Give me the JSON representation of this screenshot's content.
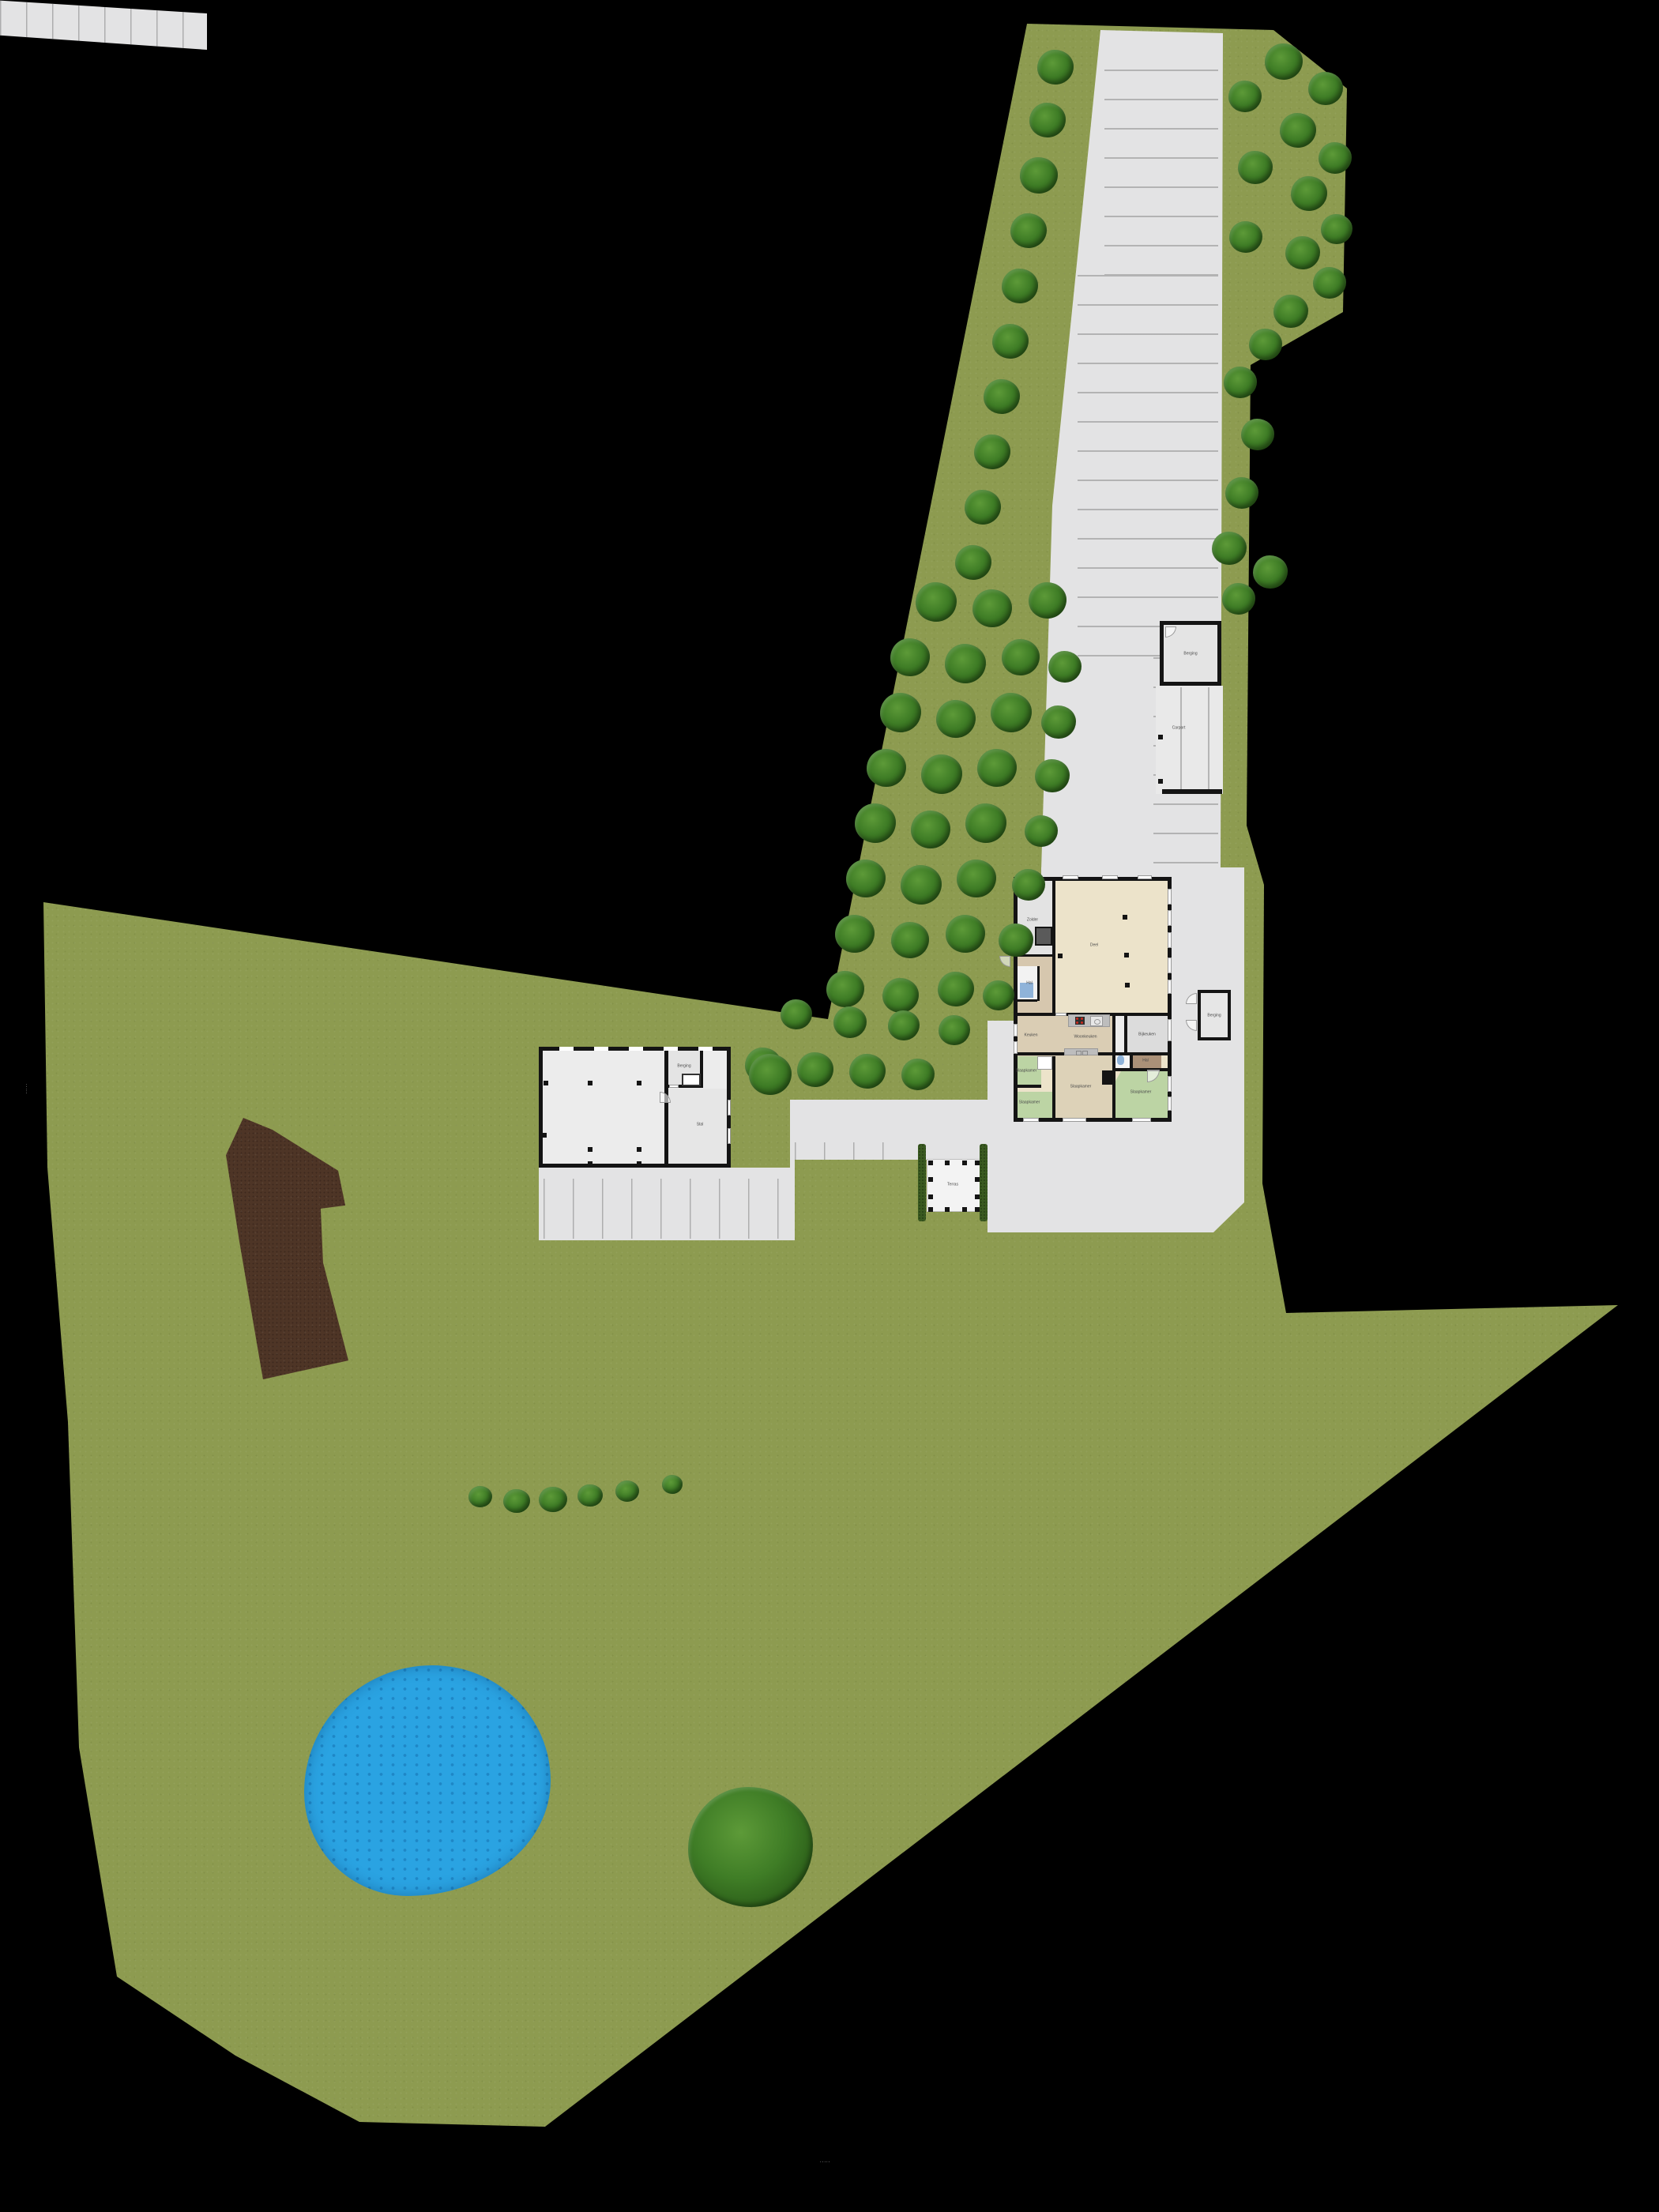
{
  "colors": {
    "background": "#000000",
    "grass": "#8d9b50",
    "pavement": "#e3e3e4",
    "wall": "#141414",
    "water": "#2aa3e2",
    "water_deep": "#1e87c6",
    "dirt": "#4e3526",
    "tree_dark": "#2a5c18",
    "tree_mid": "#3f7d26",
    "tree_light": "#5d9a38",
    "hedge": "#3a5a20",
    "room_beige": "#ece3ca",
    "room_tan": "#d6c7ae",
    "room_kitchen": "#dacdb4",
    "room_green": "#bcd4a4",
    "room_gray": "#dcdcdc",
    "room_brown": "#ab9178",
    "toilet_blue": "#8fb3d9",
    "counter": "#bdbdbd",
    "stove_red": "#cc2a1e"
  },
  "labels": {
    "watermark_left": "·····",
    "watermark_bottom": "·····",
    "garage": "Berging",
    "carport": "Carport",
    "outbuilding": "Berging",
    "pergola": "Terras",
    "barn_small": "Berging",
    "barn_large": "Stal",
    "house_attic": "Zolder",
    "house_deel": "Deel",
    "house_hall": "Hal",
    "house_kitchen_left": "Keuken",
    "house_kitchen": "Woonkeuken",
    "house_scullery": "Bijkeuken",
    "house_bed_l1": "Slaapkamer",
    "house_bed_l2": "Slaapkamer",
    "house_bed_c": "Slaapkamer",
    "house_bed_r": "Slaapkamer",
    "house_hall2": "Hal"
  },
  "trees": {
    "strip_left": [
      [
        1336,
        85,
        46
      ],
      [
        1326,
        152,
        46
      ],
      [
        1315,
        222,
        48
      ],
      [
        1302,
        292,
        46
      ],
      [
        1291,
        362,
        46
      ],
      [
        1279,
        432,
        46
      ],
      [
        1268,
        502,
        46
      ],
      [
        1256,
        572,
        46
      ],
      [
        1244,
        642,
        46
      ],
      [
        1232,
        712,
        46
      ]
    ],
    "strip_right": [
      [
        1625,
        78,
        48
      ],
      [
        1678,
        112,
        44
      ],
      [
        1643,
        165,
        46
      ],
      [
        1690,
        200,
        42
      ],
      [
        1657,
        245,
        46
      ],
      [
        1692,
        290,
        40
      ],
      [
        1649,
        320,
        44
      ],
      [
        1683,
        358,
        42
      ],
      [
        1634,
        394,
        44
      ],
      [
        1602,
        436,
        42
      ],
      [
        1577,
        300,
        42
      ],
      [
        1589,
        212,
        44
      ],
      [
        1576,
        122,
        42
      ],
      [
        1570,
        484,
        42
      ],
      [
        1592,
        550,
        42
      ],
      [
        1572,
        624,
        42
      ],
      [
        1556,
        694,
        44
      ],
      [
        1608,
        724,
        44
      ],
      [
        1568,
        758,
        42
      ]
    ],
    "orchard": [
      [
        1185,
        762,
        52
      ],
      [
        1256,
        770,
        50
      ],
      [
        1326,
        760,
        48
      ],
      [
        1152,
        832,
        50
      ],
      [
        1222,
        840,
        52
      ],
      [
        1292,
        832,
        48
      ],
      [
        1348,
        844,
        42
      ],
      [
        1140,
        902,
        52
      ],
      [
        1210,
        910,
        50
      ],
      [
        1280,
        902,
        52
      ],
      [
        1340,
        914,
        44
      ],
      [
        1122,
        972,
        50
      ],
      [
        1192,
        980,
        52
      ],
      [
        1262,
        972,
        50
      ],
      [
        1332,
        982,
        44
      ],
      [
        1108,
        1042,
        52
      ],
      [
        1178,
        1050,
        50
      ],
      [
        1248,
        1042,
        52
      ],
      [
        1318,
        1052,
        42
      ],
      [
        1096,
        1112,
        50
      ],
      [
        1166,
        1120,
        52
      ],
      [
        1236,
        1112,
        50
      ],
      [
        1302,
        1120,
        42
      ],
      [
        1082,
        1182,
        50
      ],
      [
        1152,
        1190,
        48
      ],
      [
        1222,
        1182,
        50
      ],
      [
        1286,
        1190,
        44
      ],
      [
        1070,
        1252,
        48
      ],
      [
        1140,
        1260,
        46
      ],
      [
        1210,
        1252,
        46
      ],
      [
        1264,
        1260,
        40
      ],
      [
        1008,
        1284,
        40
      ],
      [
        1076,
        1294,
        42
      ],
      [
        1144,
        1298,
        40
      ],
      [
        1208,
        1304,
        40
      ],
      [
        966,
        1348,
        46
      ],
      [
        1032,
        1354,
        46
      ],
      [
        1098,
        1356,
        46
      ],
      [
        1162,
        1360,
        42
      ]
    ],
    "scatter": [
      [
        975,
        1360,
        54
      ],
      [
        950,
        2338,
        158
      ]
    ]
  },
  "bushes": [
    [
      608,
      1894,
      30
    ],
    [
      654,
      1900,
      34
    ],
    [
      700,
      1898,
      36
    ],
    [
      747,
      1893,
      32
    ],
    [
      794,
      1887,
      30
    ],
    [
      851,
      1879,
      26
    ]
  ],
  "posts": {
    "barn": [
      [
        688,
        1368
      ],
      [
        744,
        1368
      ],
      [
        806,
        1368
      ],
      [
        744,
        1452
      ],
      [
        806,
        1452
      ],
      [
        744,
        1470
      ],
      [
        806,
        1470
      ],
      [
        686,
        1434
      ]
    ],
    "pergola": [
      [
        1175,
        1469
      ],
      [
        1196,
        1469
      ],
      [
        1218,
        1469
      ],
      [
        1234,
        1469
      ],
      [
        1175,
        1490
      ],
      [
        1234,
        1490
      ],
      [
        1175,
        1512
      ],
      [
        1234,
        1512
      ],
      [
        1175,
        1528
      ],
      [
        1196,
        1528
      ],
      [
        1218,
        1528
      ],
      [
        1234,
        1528
      ]
    ],
    "house": [
      [
        1421,
        1158
      ],
      [
        1423,
        1206
      ],
      [
        1424,
        1244
      ],
      [
        1339,
        1207
      ]
    ],
    "carport": [
      [
        1466,
        930
      ],
      [
        1466,
        986
      ]
    ]
  }
}
